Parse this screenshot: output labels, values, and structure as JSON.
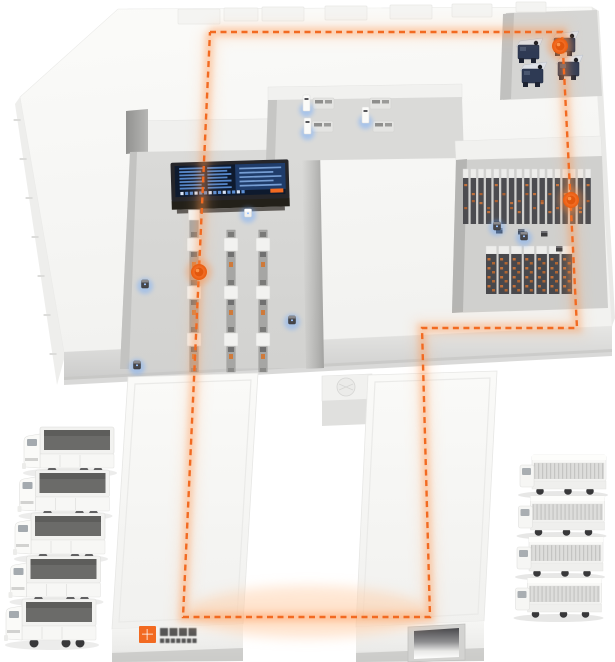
{
  "scene": {
    "width": 615,
    "height": 662,
    "background": "#ffffff",
    "subject": "Isometric 3D illustration of a smart logistics park: AGV route loop, control dashboard, conveyor lines, storage racks, loading-dock wings and truck fleets"
  },
  "palette": {
    "accent": "#f26a21",
    "route_glow": "#ff8a3c",
    "device_glow": "#6aa8ff",
    "roof": "#f6f6f4",
    "floor": "#d6d6d4",
    "facade": "#dcdcda",
    "dark_equipment": "#4c4c50",
    "screen_bg": "#0e1a2e",
    "screen_line": "#5b8fd6"
  },
  "route": {
    "color": "#f26a21",
    "dash": [
      6,
      4.5
    ],
    "width": 2.4,
    "closed": true,
    "points": [
      [
        210,
        32
      ],
      [
        562,
        32
      ],
      [
        577,
        328
      ],
      [
        422,
        328
      ],
      [
        430,
        617
      ],
      [
        183,
        617
      ],
      [
        210,
        32
      ]
    ]
  },
  "markers": [
    {
      "name": "waypoint-top-dock",
      "x": 560,
      "y": 46
    },
    {
      "name": "waypoint-storage-racks",
      "x": 571,
      "y": 200
    },
    {
      "name": "waypoint-conveyor-line",
      "x": 199,
      "y": 272
    }
  ],
  "conveyors": {
    "belt_color": "#a6a6a4",
    "station_color": "#f2f2f0",
    "item_color": "#cf7a3a",
    "lines": [
      {
        "x": 194,
        "top": 212,
        "bottom": 372,
        "top_box": true
      },
      {
        "x": 231,
        "top": 224,
        "bottom": 372,
        "top_box": false
      },
      {
        "x": 263,
        "top": 224,
        "bottom": 372,
        "top_box": false
      }
    ],
    "station_ys": [
      238,
      286,
      333
    ],
    "item_ys": [
      262,
      310,
      354
    ]
  },
  "racks": {
    "tall": {
      "count": 17,
      "x0": 463,
      "dx": 7.65,
      "y": 169,
      "cap_h": 9,
      "body_h": 46,
      "w": 5.4
    },
    "short": {
      "count": 7,
      "x0": 486,
      "dx": 12.6,
      "y": 246,
      "cap_h": 8,
      "body_h": 40,
      "w": 10.5
    },
    "floor_boxes": [
      [
        496,
        228
      ],
      [
        518,
        229
      ],
      [
        541,
        231
      ],
      [
        556,
        246
      ]
    ]
  },
  "workstations": {
    "tables": [
      [
        313,
        98
      ],
      [
        312,
        121
      ],
      [
        370,
        98
      ],
      [
        373,
        121
      ]
    ],
    "machines": [
      [
        303,
        95
      ],
      [
        304,
        118
      ],
      [
        362,
        107
      ]
    ]
  },
  "dock_machines": [
    [
      516,
      38
    ],
    [
      552,
      31
    ],
    [
      520,
      62
    ],
    [
      556,
      55
    ]
  ],
  "devices": [
    {
      "x": 145,
      "y": 284,
      "variant": "dark"
    },
    {
      "x": 248,
      "y": 213,
      "variant": "white"
    },
    {
      "x": 292,
      "y": 320,
      "variant": "dark"
    },
    {
      "x": 137,
      "y": 365,
      "variant": "dark"
    },
    {
      "x": 497,
      "y": 226,
      "variant": "dark"
    },
    {
      "x": 524,
      "y": 236,
      "variant": "dark"
    }
  ],
  "trucks_left": {
    "count": 5,
    "x0": 22,
    "y0": 427,
    "step_y": 43,
    "step_x": -4.5
  },
  "trucks_right": {
    "count": 4,
    "x0": 518,
    "y0": 455,
    "step_y": 41,
    "step_x": -1.5
  },
  "dashboard": {
    "x": 171,
    "y": 161,
    "w": 118,
    "h": 39,
    "left_rows": 7,
    "mid_rows": 7,
    "right_rows": 5,
    "tick_count": 14
  },
  "roof_blocks": [
    [
      178,
      9,
      42,
      15
    ],
    [
      224,
      8,
      34,
      13
    ],
    [
      262,
      7,
      42,
      14
    ],
    [
      325,
      6,
      42,
      14
    ],
    [
      390,
      5,
      42,
      14
    ],
    [
      452,
      4,
      40,
      13
    ],
    [
      516,
      2,
      30,
      10
    ]
  ],
  "facade_vents": [
    [
      184,
      360
    ],
    [
      219,
      359
    ],
    [
      248,
      358
    ]
  ],
  "logo": {
    "x": 139,
    "y": 626,
    "mark_color": "#f26a21",
    "text_color": "#3a3a3a",
    "lines": 2,
    "legible": false
  }
}
